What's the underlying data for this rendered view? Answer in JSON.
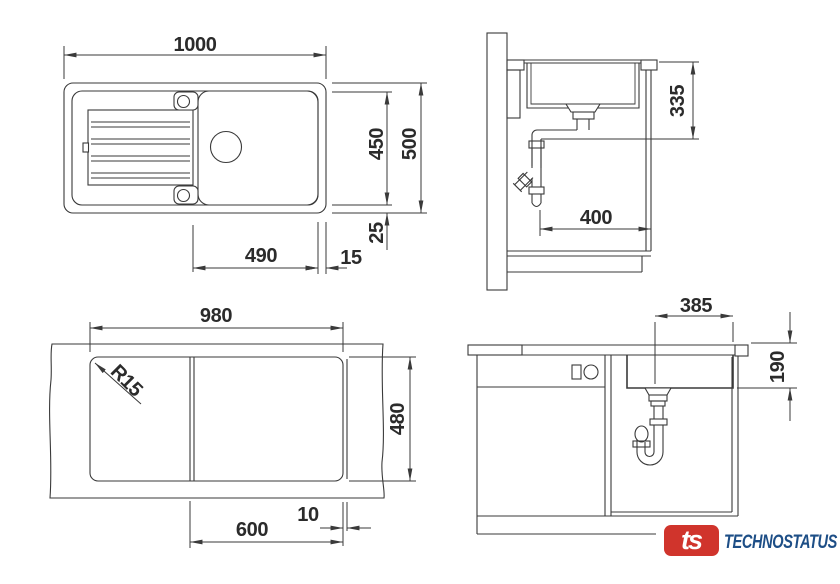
{
  "colors": {
    "line": "#3a3a3a",
    "text": "#2b2b2b",
    "logo_red": "#d0342c",
    "logo_blue": "#1d4e86",
    "background": "#ffffff"
  },
  "views": {
    "top_view": {
      "overall_width": "1000",
      "basin_depth": "450",
      "overall_depth": "500",
      "rim_gap": "25",
      "bowl_width": "490",
      "edge_gap": "15"
    },
    "side_section": {
      "drain_height": "335",
      "wall_clearance": "400"
    },
    "cutout_view": {
      "cutout_width": "980",
      "corner_radius": "R15",
      "cutout_depth": "480",
      "bowl_section_width": "600",
      "edge_line_gap": "10"
    },
    "front_section": {
      "drain_offset": "385",
      "bowl_depth": "190"
    }
  },
  "logo": {
    "monogram": "ts",
    "brand": "TECHNOSTATUS"
  }
}
